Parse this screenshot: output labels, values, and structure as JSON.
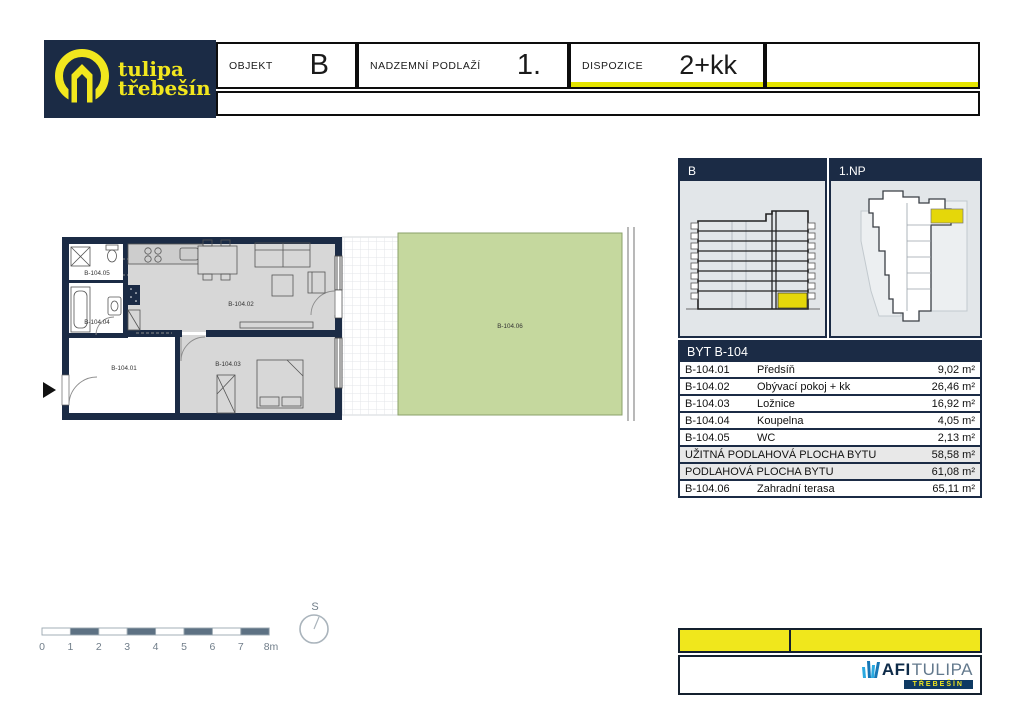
{
  "colors": {
    "navy": "#1b2b45",
    "brand_yellow": "#f2e71e",
    "underline_yellow": "#e4e400",
    "terrace_green": "#c5d89e",
    "floor_gray": "#d7d7d7",
    "highlight_yellow": "#e5d70a"
  },
  "header": {
    "brand": {
      "line1": "tulipa",
      "line2": "třebešín"
    },
    "objekt_label": "OBJEKT",
    "objekt_value": "B",
    "podlazi_label": "NADZEMNÍ PODLAŽÍ",
    "podlazi_value": "1.",
    "dispozice_label": "DISPOZICE",
    "dispozice_value": "2+kk"
  },
  "plan": {
    "labels": {
      "r01": "B-104.01",
      "r02": "B-104.02",
      "r03": "B-104.03",
      "r04": "B-104.04",
      "r05": "B-104.05",
      "r06": "B-104.06"
    }
  },
  "panels": {
    "elevation_title": "B",
    "floor_title": "1.NP"
  },
  "table": {
    "title": "BYT B-104",
    "rows": [
      {
        "code": "B-104.01",
        "name": "Předsíň",
        "area": "9,02 m²"
      },
      {
        "code": "B-104.02",
        "name": "Obývací pokoj + kk",
        "area": "26,46 m²"
      },
      {
        "code": "B-104.03",
        "name": "Ložnice",
        "area": "16,92 m²"
      },
      {
        "code": "B-104.04",
        "name": "Koupelna",
        "area": "4,05 m²"
      },
      {
        "code": "B-104.05",
        "name": "WC",
        "area": "2,13 m²"
      }
    ],
    "summaries": [
      {
        "name": "UŽITNÁ PODLAHOVÁ PLOCHA BYTU",
        "area": "58,58 m²"
      },
      {
        "name": "PODLAHOVÁ PLOCHA BYTU",
        "area": "61,08 m²"
      }
    ],
    "terrace": {
      "code": "B-104.06",
      "name": "Zahradní terasa",
      "area": "65,11 m²"
    }
  },
  "scalebar": {
    "ticks": [
      "0",
      "1",
      "2",
      "3",
      "4",
      "5",
      "6",
      "7",
      "8m"
    ],
    "north_label": "S"
  },
  "footer": {
    "afi": "AFI",
    "tulipa": "TULIPA",
    "sub": "TŘEBEŠÍN"
  }
}
